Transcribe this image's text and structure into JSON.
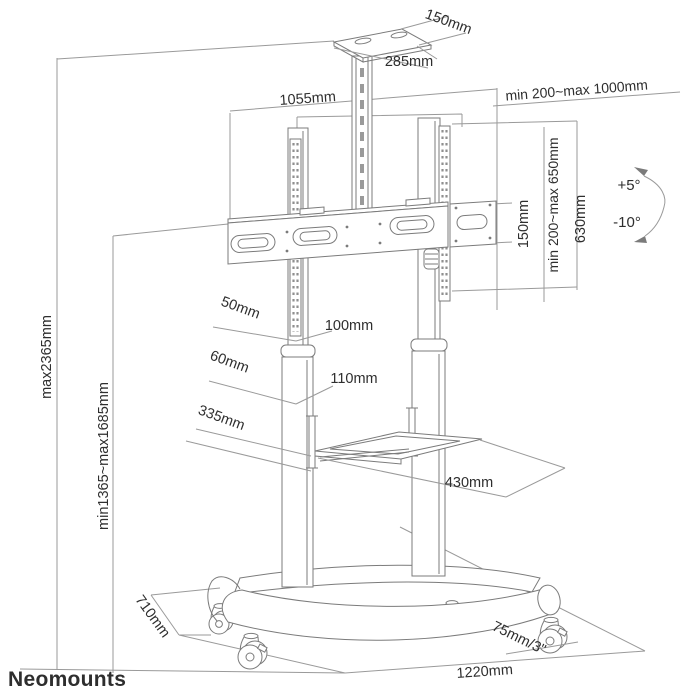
{
  "page": {
    "background": "#ffffff",
    "type": "technical-dimension-diagram",
    "product": "mobile TV floor stand"
  },
  "palette": {
    "structure_stroke": "#7b7b7b",
    "dimension_stroke": "#9a9a9a",
    "text_color": "#2e2e2e",
    "watermark_color": "#9c9c9c"
  },
  "watermark": {
    "brand": "Neomounts"
  },
  "annotations": {
    "top_shelf_depth": "150mm",
    "top_shelf_width": "285mm",
    "columns_span": "1055mm",
    "mount_width_range": "min 200~max 1000mm",
    "bracket_offset": "150mm",
    "mount_height_range": "min 200~max 650mm",
    "bracket_height": "630mm",
    "tilt_up": "+5°",
    "tilt_down": "-10°",
    "total_height": "max2365mm",
    "screen_center_height": "min1365~max1685mm",
    "upper_column_width": "50mm",
    "upper_column_depth": "100mm",
    "lower_column_width": "60mm",
    "lower_column_depth": "110mm",
    "shelf_depth": "335mm",
    "shelf_width": "430mm",
    "base_depth": "710mm",
    "caster_size": "75mm/3\"",
    "base_width": "1220mm"
  }
}
